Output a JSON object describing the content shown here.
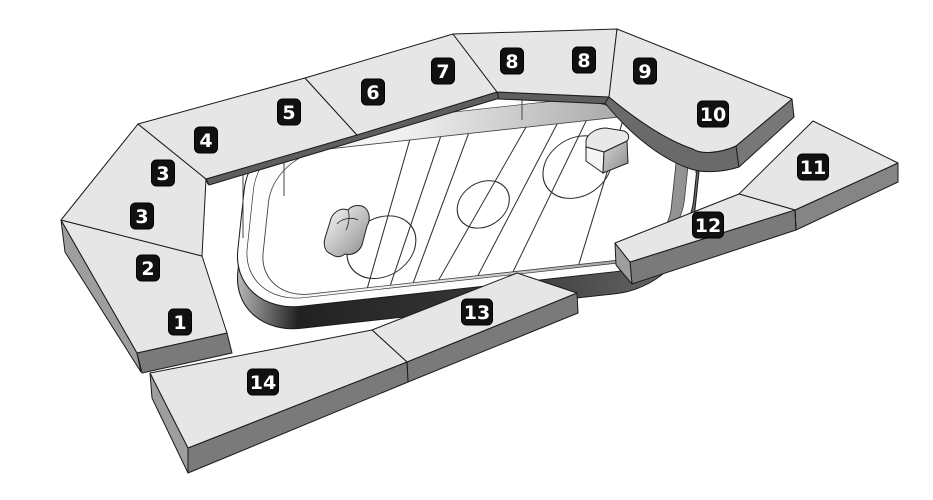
{
  "canvas": {
    "width": 933,
    "height": 500,
    "background": "#ffffff"
  },
  "colors": {
    "background": "#ffffff",
    "panel_top": "#e6e6e6",
    "panel_side": "#858585",
    "panel_side_light": "#9e9e9e",
    "panel_side_dark": "#5e5e5e",
    "outline": "#1a1a1a",
    "badge_bg": "#111111",
    "badge_border": "#000000",
    "badge_text": "#ffffff",
    "ice": "#ffffff",
    "marking": "#333333"
  },
  "diagram": {
    "type": "arena-seating-map",
    "subject": "ice-hockey-rink"
  },
  "sections": [
    {
      "label": "1",
      "x": 180,
      "y": 322
    },
    {
      "label": "2",
      "x": 148,
      "y": 268
    },
    {
      "label": "3",
      "x": 142,
      "y": 216
    },
    {
      "label": "3",
      "x": 163,
      "y": 173
    },
    {
      "label": "4",
      "x": 206,
      "y": 140
    },
    {
      "label": "5",
      "x": 289,
      "y": 112
    },
    {
      "label": "6",
      "x": 373,
      "y": 92
    },
    {
      "label": "7",
      "x": 443,
      "y": 71
    },
    {
      "label": "8",
      "x": 512,
      "y": 61
    },
    {
      "label": "8",
      "x": 584,
      "y": 60
    },
    {
      "label": "9",
      "x": 645,
      "y": 71
    },
    {
      "label": "10",
      "x": 713,
      "y": 114
    },
    {
      "label": "11",
      "x": 813,
      "y": 167
    },
    {
      "label": "12",
      "x": 708,
      "y": 225
    },
    {
      "label": "13",
      "x": 477,
      "y": 312
    },
    {
      "label": "14",
      "x": 263,
      "y": 382
    }
  ]
}
